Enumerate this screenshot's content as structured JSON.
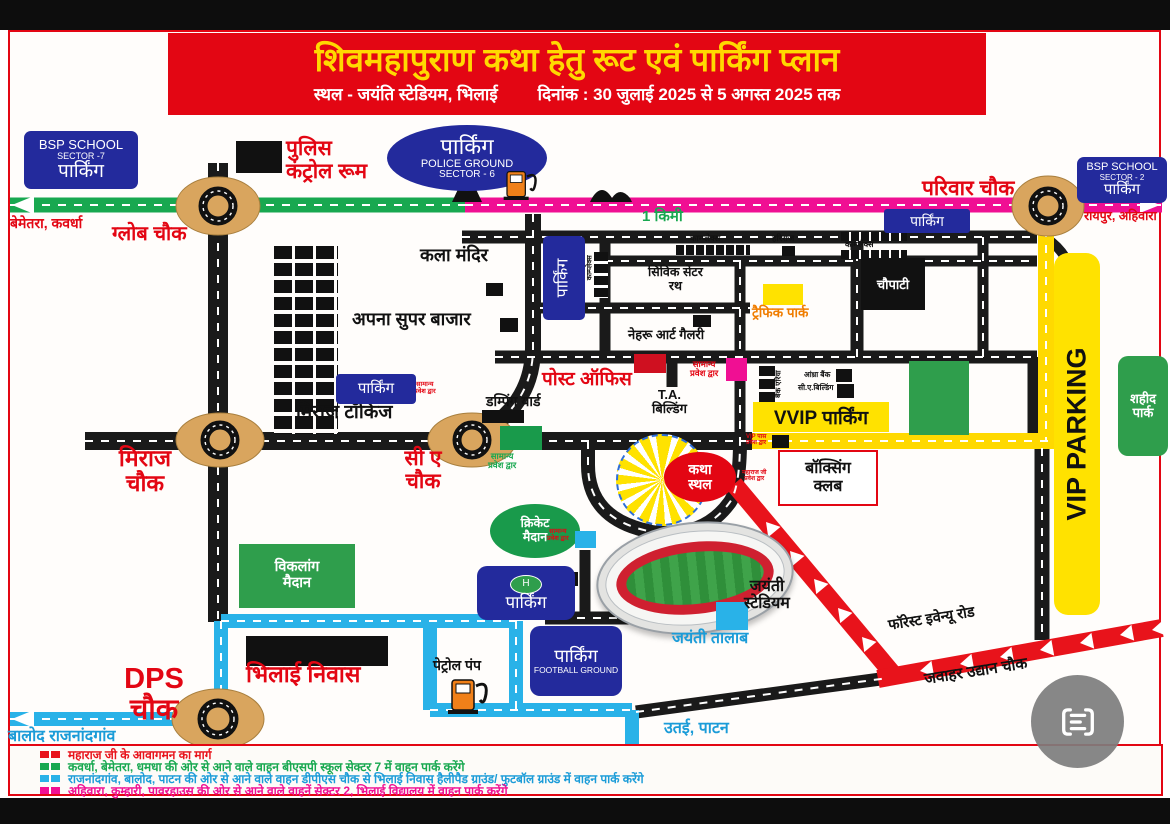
{
  "banner": {
    "title": "शिवमहापुराण कथा हेतु रूट एवं पार्किंग प्लान",
    "venue": "स्थल - जयंति स्टेडियम, भिलाई",
    "date": "दिनांक : 30 जुलाई 2025 से 5 अगस्त 2025 तक"
  },
  "signs": {
    "bsp7": {
      "l1": "BSP SCHOOL",
      "l2": "SECTOR -7",
      "l3": "पार्किंग"
    },
    "police_ground": {
      "l1": "पार्किंग",
      "l2": "POLICE GROUND",
      "l3": "SECTOR - 6"
    },
    "bsp2": {
      "l1": "BSP SCHOOL",
      "l2": "SECTOR - 2",
      "l3": "पार्किंग"
    },
    "road_parking": "पार्किंग",
    "complex_parking": "पार्किंग",
    "miraj_parking": "पार्किंग",
    "helipad_parking": {
      "icon": "H",
      "label": "पार्किंग"
    },
    "football_parking": {
      "l1": "पार्किंग",
      "l2": "FOOTBALL GROUND"
    },
    "vvip": "VVIP पार्किंग",
    "vip": "VIP PARKING"
  },
  "chowks": {
    "globe": "ग्लोब चौक",
    "parivar": "परिवार चौक",
    "miraj": "मिराज\nचौक",
    "ca": "सी ए\nचौक",
    "dps": "DPS\nचौक",
    "jawahar": "जवाहर उद्यान चौक"
  },
  "directions": {
    "bemetara": "बेमेतरा, कवर्धा",
    "raipur": "रायपुर, अहिवारा",
    "balod": "बालोद राजनांदगांव",
    "utai": "उतई, पाटन",
    "forest_road": "फॉरेस्ट इवेन्यू रोड",
    "km": "1 किमी"
  },
  "places": {
    "police_control": "पुलिस\nकंट्रोल रूम",
    "kala_mandir": "कला मंदिर",
    "apna_super": "अपना सुपर बाजार",
    "miraj_talkies": "मिराज टॉकिज",
    "dumping_yard": "डम्पिंग यार्ड",
    "post_office": "पोस्ट ऑफिस",
    "ta_building": "T.A.\nबिल्डिंग",
    "civic_center": "सिविक सेंटर\nरथ",
    "complex": "काम्प्लेक्स",
    "hariraj": "हरिराज",
    "nehru": "नेहरू आर्ट गैलरी",
    "traffic_park": "ट्रैफिक पार्क",
    "chaupati": "चौपाटी",
    "andhra_bank": "आंध्रा बैंक",
    "ca_building": "सी.ए.बिल्डिंग",
    "bank_area": "बैंक एरिया",
    "shahid_park": "शहीद\nपार्क",
    "viklang": "विकलांग\nमैदान",
    "cricket": "क्रिकेट\nमैदान",
    "katha_sthal": "कथा\nस्थल",
    "boxing": "बॉक्सिंग\nक्लब",
    "stadium": "जयंती\nस्टेडियम",
    "talab": "जयंती तालाब",
    "bhilai_niwas": "भिलाई निवास",
    "petrol": "पेट्रोल पंप"
  },
  "gates": {
    "samanya": "सामान्य\nप्रवेश द्वार",
    "vip_pass": "VIP पास\nप्रवेश द्वार",
    "maharaj": "महाराज जी\nप्रवेश द्वार"
  },
  "legend": {
    "items": [
      {
        "color": "#e8131b",
        "text": "महाराज जी के आवागमन का मार्ग"
      },
      {
        "color": "#18a850",
        "text": "कवर्धा, बेमेतरा, धमधा की ओर से आने वाले वाहन बीएसपी स्कूल सेक्टर 7 में वाहन पार्क करेंगे"
      },
      {
        "color": "#29b2e8",
        "text": "राजनांदगांव, बालोद, पाटन की ओर से आने वाले वाहन डीपीएस चौक से भिलाई निवास हैलीपैड ग्राउंड/ फुटबॉल ग्राउंड में वाहन पार्क करेंगे"
      },
      {
        "color": "#f00f93",
        "text": "अहिवारा, कुम्हारी, पावरहाउस  की ओर से आने वाले वाहनें  सेक्टर 2, भिलाई विद्यालय में वाहन पार्क करेंगे"
      }
    ]
  },
  "colors": {
    "banner_red": "#e30613",
    "banner_yellow": "#ffd900",
    "sign_blue": "#232a9c",
    "route_red": "#e8131b",
    "route_green": "#18a850",
    "route_blue": "#29b2e8",
    "route_pink": "#f00f93",
    "route_yellow": "#ffd900",
    "roundabout_tan": "#d9a55e"
  }
}
